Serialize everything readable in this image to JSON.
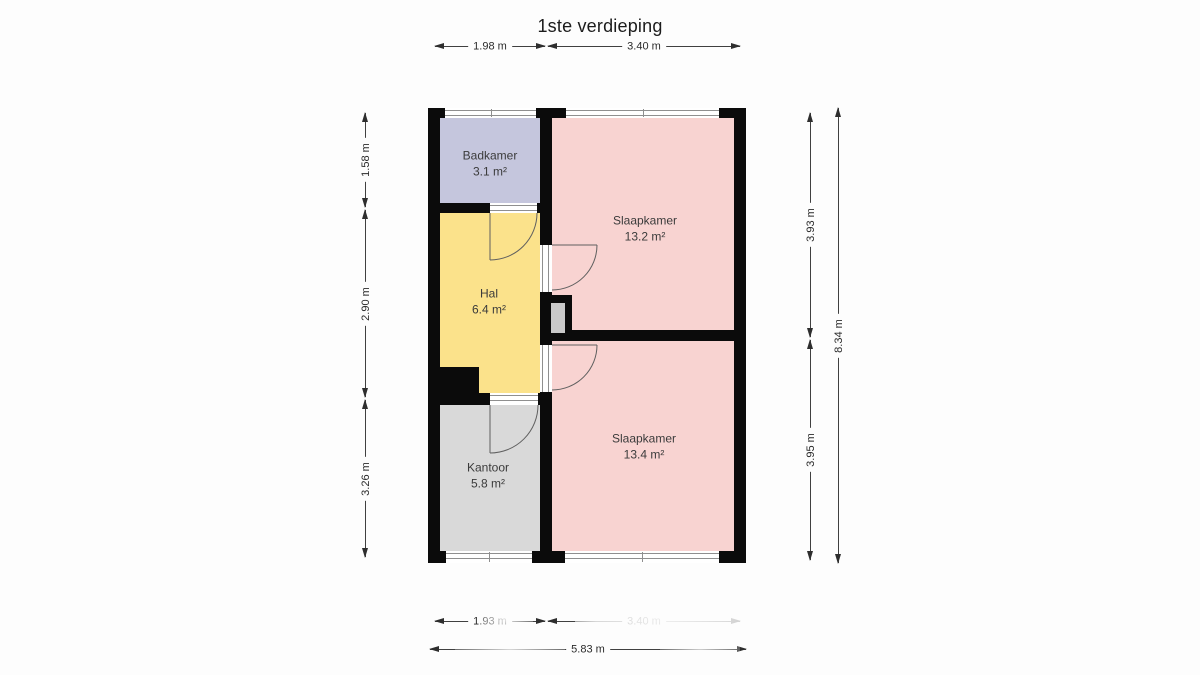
{
  "title": "1ste verdieping",
  "rooms": {
    "badkamer": {
      "name": "Badkamer",
      "area": "3.1 m²"
    },
    "slaapkamer1": {
      "name": "Slaapkamer",
      "area": "13.2 m²"
    },
    "hal": {
      "name": "Hal",
      "area": "6.4 m²"
    },
    "slaapkamer2": {
      "name": "Slaapkamer",
      "area": "13.4 m²"
    },
    "kantoor": {
      "name": "Kantoor",
      "area": "5.8 m²"
    }
  },
  "dimensions": {
    "top_left": "1.98 m",
    "top_right": "3.40 m",
    "left_top": "1.58 m",
    "left_middle": "2.90 m",
    "left_bottom": "3.26 m",
    "right_top": "3.93 m",
    "right_bottom": "3.95 m",
    "right_total": "8.34 m",
    "bottom_left": "1.93 m",
    "bottom_right": "3.40 m",
    "bottom_total": "5.83 m"
  },
  "colors": {
    "badkamer": "#c5c6dd",
    "slaapkamer": "#f8d3d1",
    "hal": "#fbe28b",
    "kantoor": "#d9d9d9",
    "wall": "#0b0b0b",
    "shaft": "#c9c9c9"
  }
}
